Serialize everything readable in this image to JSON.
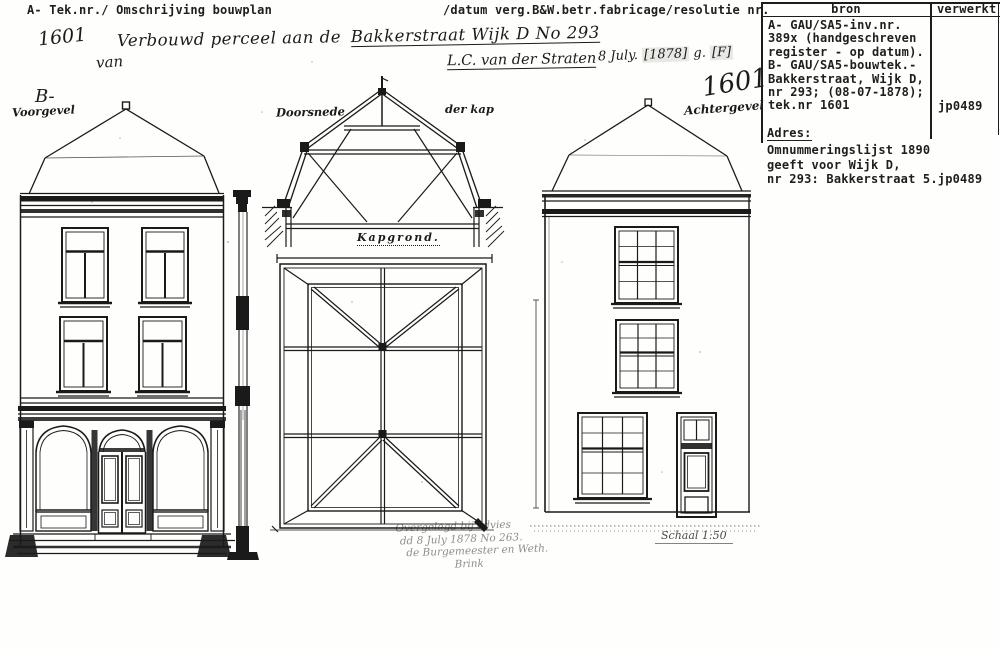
{
  "typed_header": {
    "left": "A- Tek.nr./ Omschrijving bouwplan",
    "right": "/datum verg.B&W.betr.fabricage/resolutie nr."
  },
  "handwritten_header": {
    "tek_nr": "1601",
    "description": "Verbouwd perceel aan de",
    "description_underlined": "Bakkerstraat Wijk D No 293",
    "prefix_line2": "van",
    "owner": "L.C. van der Straten",
    "date_day": "8 July.",
    "date_year": "[1878]",
    "date_g": "g.",
    "date_f": "[F]"
  },
  "source_table": {
    "col_bron": "bron",
    "col_verwerkt": "verwerkt",
    "bron_lines": [
      "A- GAU/SA5-inv.nr.",
      "389x (handgeschreven",
      "register - op datum).",
      "B- GAU/SA5-bouwtek.-",
      "Bakkerstraat, Wijk D,",
      "nr 293; (08-07-1878);",
      "tek.nr 1601"
    ],
    "verwerkt_value": "jp0489",
    "adres_label": "Adres:",
    "adres_lines": [
      "Omnummeringslijst 1890",
      "geeft voor Wijk D,",
      "nr 293: Bakkerstraat 5.jp0489"
    ]
  },
  "drawing_labels": {
    "front_marker": "B-",
    "front_title": "Voorgevel",
    "section_title_left": "Doorsnede",
    "section_title_right": "der kap",
    "plan_title": "Kapgrond.",
    "rear_number": "1601",
    "rear_title": "Achtergevel",
    "scale_note": "Schaal 1:50"
  },
  "approval_note": {
    "line1": "Overgelegd bij advies",
    "line2": "dd 8 July 1878 No 263.",
    "line3": "de Burgemeester en Weth.",
    "line4": "Brink"
  },
  "colors": {
    "ink": "#1c1c1c",
    "paper": "#fefefd",
    "stamp_highlight": "#e8e8e4"
  }
}
